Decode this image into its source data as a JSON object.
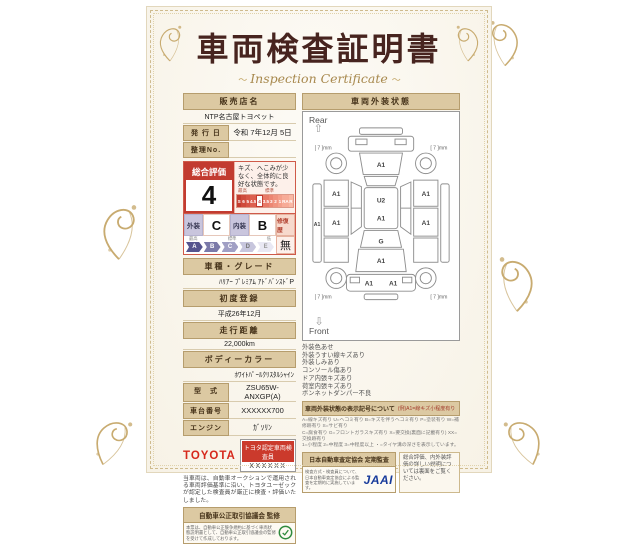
{
  "title": {
    "main": "車両検査証明書",
    "sub": "Inspection Certificate"
  },
  "dealer": {
    "label": "販売店名",
    "value": "NTP名古屋トヨペット"
  },
  "issue": {
    "label": "発 行 日",
    "value": "令和 7年12月 5日"
  },
  "ref_no": {
    "label": "整理No.",
    "value": ""
  },
  "assessment": {
    "label": "総合評価",
    "score": "4",
    "description": "キズ、へこみが少なく、全体的に良好な状態です。",
    "scale_top": [
      "最高",
      "標準",
      ""
    ],
    "scale_values": [
      "S",
      "6",
      "5",
      "4.5",
      "4",
      "3.5",
      "3",
      "2",
      "1",
      "RA",
      "R"
    ],
    "selected_value": "4",
    "exterior_label": "外装",
    "exterior_value": "C",
    "interior_label": "内装",
    "interior_value": "B",
    "repair_label": "修復歴",
    "repair_value": "無",
    "grade_top": [
      "最高",
      "標準",
      "低"
    ],
    "grade_scale": [
      "A",
      "B",
      "C",
      "D",
      "E"
    ]
  },
  "fields": {
    "model_label": "車種・グレード",
    "model_value": "ﾊﾘｱｰ ﾌﾟﾚﾐｱﾑ ｱﾄﾞﾊﾞﾝｽﾄﾞP",
    "first_reg_label": "初度登録",
    "first_reg_value": "平成26年12月",
    "mileage_label": "走行距離",
    "mileage_value": "22,000km",
    "color_label": "ボディーカラー",
    "color_value": "ﾎﾜｲﾄﾊﾟｰﾙｸﾘｽﾀﾙｼｬｲﾝ",
    "type_label": "型　式",
    "type_value": "ZSU65W-ANXGP(A)",
    "chassis_label": "車台番号",
    "chassis_value": "XXXXXX700",
    "engine_label": "エンジン",
    "engine_value": "ｶﾞｿﾘﾝ"
  },
  "inspector": {
    "brand": "TOYOTA",
    "badge": "トヨタ認定車両検査員",
    "id": "XXXXXX"
  },
  "disclaimer": "当車両は、自動車オークションで運用される車両評価基準に沿い、トヨタユーゼックが認定した検査員が厳正に検査・評価いたしました。",
  "fair_trade": {
    "header": "自動車公正取引協議会 監修",
    "body": "本票は、自動車公正競争規約に基づく車両状態説明書として、自動車公正取引協議会の監修を受けて作成しております。"
  },
  "exterior": {
    "header": "車両外装状態",
    "rear": "Rear",
    "front": "Front",
    "tire": "[ 7 ]mm",
    "labels": {
      "sill": "A1",
      "l1": "A1",
      "l2": "A1",
      "r1": "A1",
      "r2": "A1",
      "gate": "A1",
      "roof_u": "U2",
      "roof_a": "A1",
      "windshield": "G",
      "hood": "A1",
      "bumper_l": "A1",
      "bumper_r": "A1"
    },
    "notes": [
      "外装色あせ",
      "外装うすい線キズあり",
      "外装しみあり",
      "コンソール傷あり",
      "ドア内張キズあり",
      "荷室内張キズあり",
      "ボンネットダンパー不良"
    ]
  },
  "legend": {
    "header": "車両外装状態の表示記号について",
    "example": "(例)A1=線キズ小程度有り",
    "lines": [
      "A=線キズ有り U=ヘコミ有り B=キズを伴うヘコミ有り P=塗装有り W=補修跡有り S=サビ有り",
      "C=腐食有り G=フロントガラスキズ有り X=要交換(裏面に記載有り) XX=交換跡有り",
      "1=小程度 2=中程度 3=中程度以上 ・=タイヤ溝の深さを表示しています。"
    ]
  },
  "audit": {
    "header": "日本自動車査定協会 定期監査",
    "body": "検査方式・検査員について、日本自動車査定協会による監査を定期的に実施しています。",
    "logo": "JAAI"
  },
  "back_note": "総合評価、内外装評価の詳しい説明については裏面をご覧ください。"
}
